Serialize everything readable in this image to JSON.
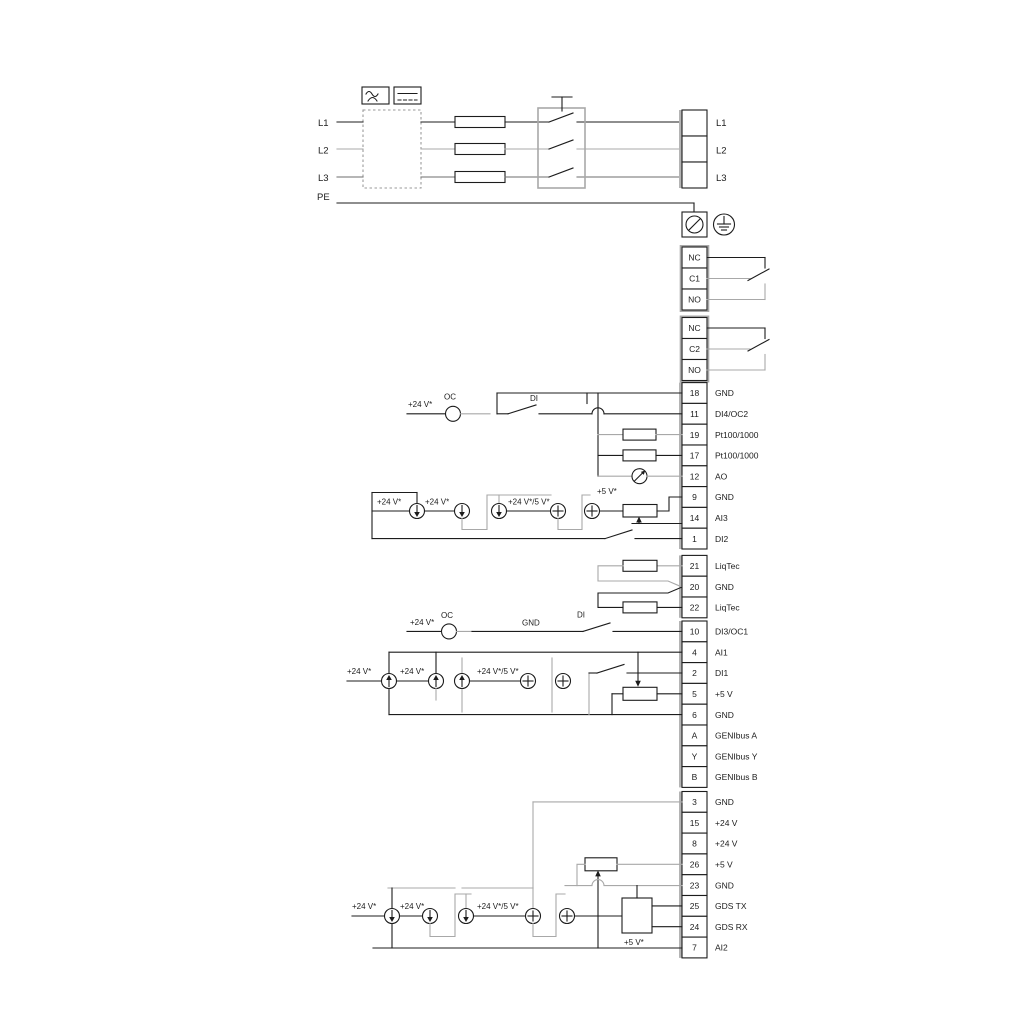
{
  "diagram": {
    "mains": {
      "left_labels": [
        "L1",
        "L2",
        "L3",
        "PE"
      ],
      "right_labels": [
        "L1",
        "L2",
        "L3"
      ]
    },
    "relays": {
      "relay1": [
        "NC",
        "C1",
        "NO"
      ],
      "relay2": [
        "NC",
        "C2",
        "NO"
      ]
    },
    "terminal_groups": {
      "io1": [
        {
          "n": "18",
          "l": "GND"
        },
        {
          "n": "11",
          "l": "DI4/OC2"
        },
        {
          "n": "19",
          "l": "Pt100/1000"
        },
        {
          "n": "17",
          "l": "Pt100/1000"
        },
        {
          "n": "12",
          "l": "AO"
        },
        {
          "n": "9",
          "l": "GND"
        },
        {
          "n": "14",
          "l": "AI3"
        },
        {
          "n": "1",
          "l": "DI2"
        }
      ],
      "liqtec": [
        {
          "n": "21",
          "l": "LiqTec"
        },
        {
          "n": "20",
          "l": "GND"
        },
        {
          "n": "22",
          "l": "LiqTec"
        }
      ],
      "io2": [
        {
          "n": "10",
          "l": "DI3/OC1"
        },
        {
          "n": "4",
          "l": "AI1"
        },
        {
          "n": "2",
          "l": "DI1"
        },
        {
          "n": "5",
          "l": "+5 V"
        },
        {
          "n": "6",
          "l": "GND"
        },
        {
          "n": "A",
          "l": "GENIbus A"
        },
        {
          "n": "Y",
          "l": "GENIbus Y"
        },
        {
          "n": "B",
          "l": "GENIbus B"
        }
      ],
      "io3": [
        {
          "n": "3",
          "l": "GND"
        },
        {
          "n": "15",
          "l": "+24 V"
        },
        {
          "n": "8",
          "l": "+24 V"
        },
        {
          "n": "26",
          "l": "+5 V"
        },
        {
          "n": "23",
          "l": "GND"
        },
        {
          "n": "25",
          "l": "GDS TX"
        },
        {
          "n": "24",
          "l": "GDS RX"
        },
        {
          "n": "7",
          "l": "AI2"
        }
      ]
    },
    "annotations": {
      "v24": "+24 V*",
      "v24_5": "+24 V*/5 V*",
      "v5": "+5 V*",
      "oc": "OC",
      "di": "DI",
      "gnd": "GND"
    },
    "colors": {
      "wire": "#1c1c1c",
      "alt_wire": "#a8a8a8",
      "terminal_band": "#b4b4b4"
    }
  }
}
